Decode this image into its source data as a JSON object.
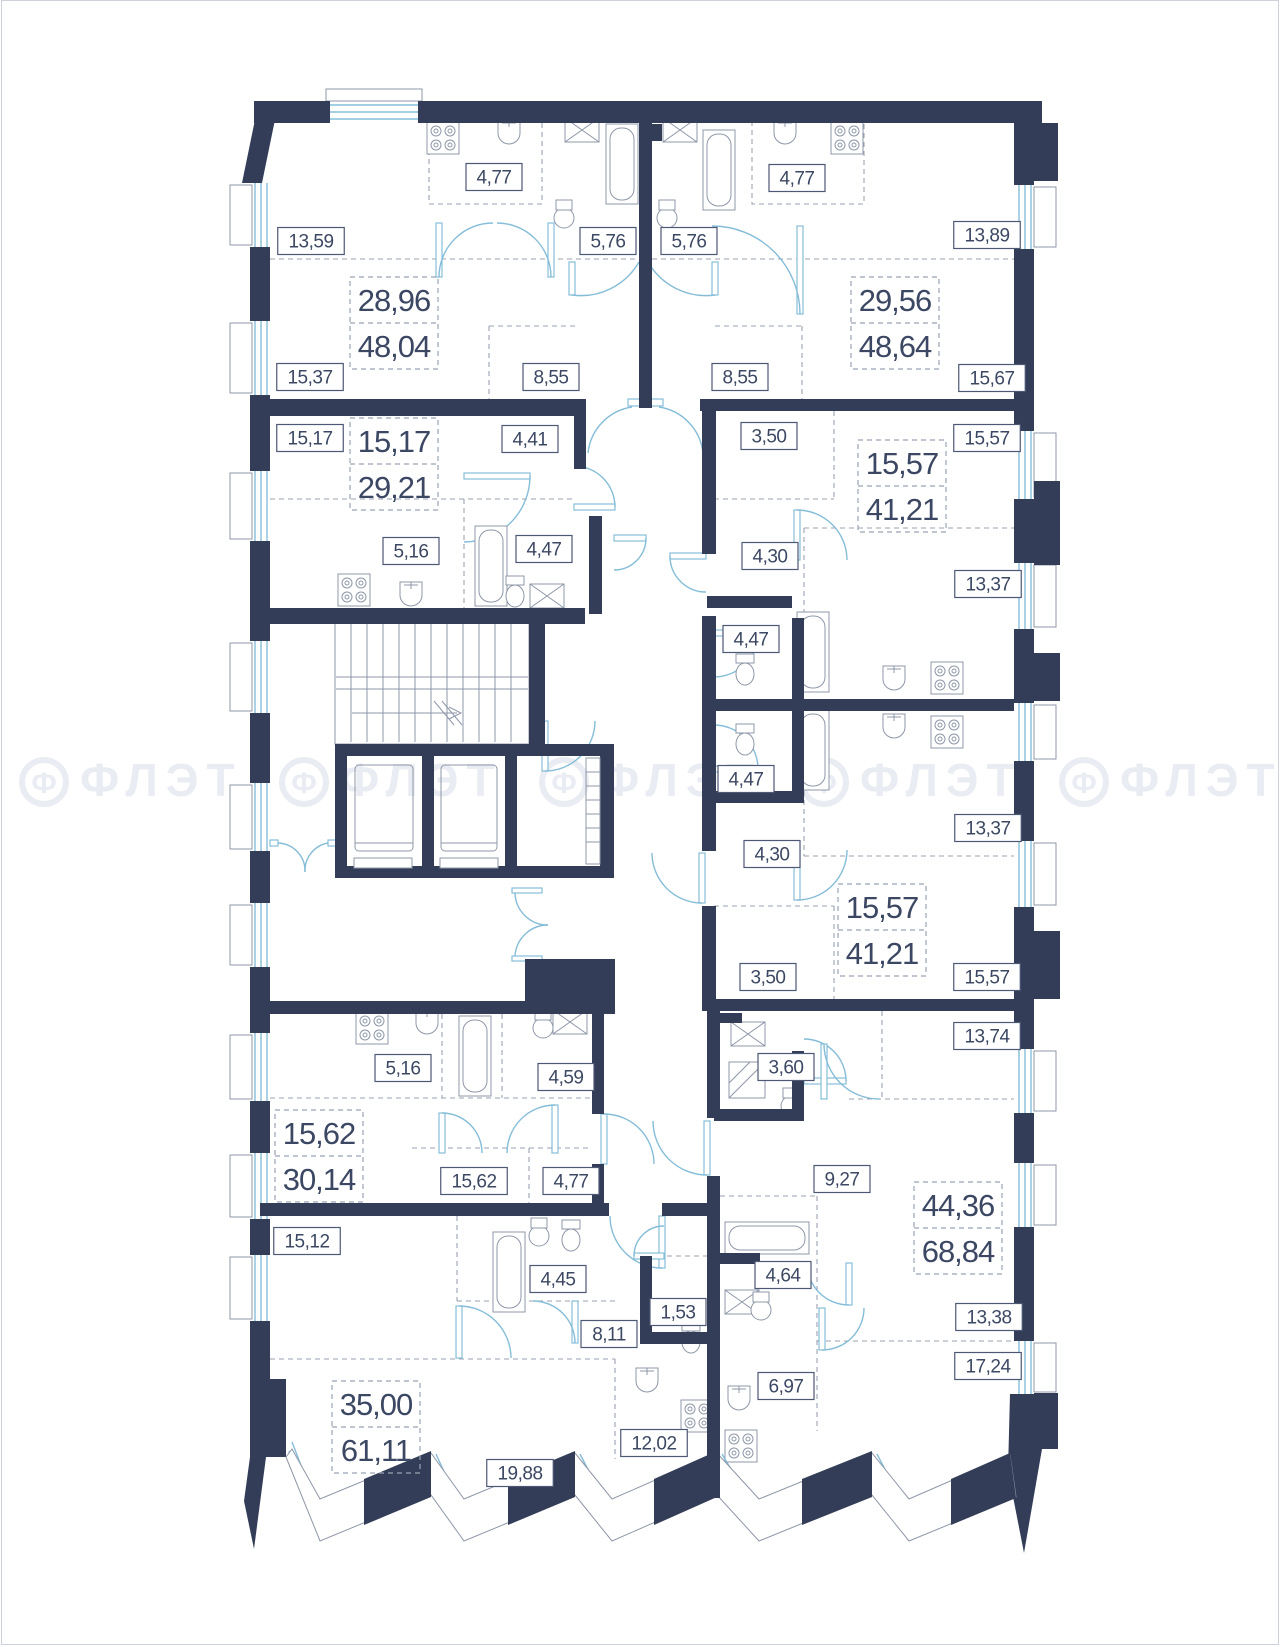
{
  "plan": {
    "colors": {
      "wall": "#333d57",
      "glazing": "#85bdd8",
      "label_text": "#3c4863",
      "dashed_zone": "#9aa3b3",
      "watermark": "#e9ecf2"
    },
    "watermark": {
      "logo_letter": "Ф",
      "text": "ФЛЭТ",
      "y": 795,
      "positions_x": [
        130,
        390,
        650,
        910,
        1170
      ]
    },
    "apartments": [
      {
        "living": "28,96",
        "total": "48,04",
        "cx": 392,
        "cy": 322
      },
      {
        "living": "29,56",
        "total": "48,64",
        "cx": 893,
        "cy": 322
      },
      {
        "living": "15,17",
        "total": "29,21",
        "cx": 392,
        "cy": 463
      },
      {
        "living": "15,57",
        "total": "41,21",
        "cx": 900,
        "cy": 485
      },
      {
        "living": "15,57",
        "total": "41,21",
        "cx": 880,
        "cy": 929
      },
      {
        "living": "15,62",
        "total": "30,14",
        "cx": 317,
        "cy": 1155
      },
      {
        "living": "44,36",
        "total": "68,84",
        "cx": 956,
        "cy": 1227
      },
      {
        "living": "35,00",
        "total": "61,11",
        "cx": 374,
        "cy": 1426
      }
    ],
    "room_labels": [
      {
        "text": "4,77",
        "cx": 492,
        "cy": 176
      },
      {
        "text": "13,59",
        "cx": 309,
        "cy": 240
      },
      {
        "text": "5,76",
        "cx": 606,
        "cy": 240
      },
      {
        "text": "15,37",
        "cx": 308,
        "cy": 376
      },
      {
        "text": "8,55",
        "cx": 549,
        "cy": 376
      },
      {
        "text": "4,77",
        "cx": 795,
        "cy": 177
      },
      {
        "text": "5,76",
        "cx": 687,
        "cy": 240
      },
      {
        "text": "13,89",
        "cx": 985,
        "cy": 234
      },
      {
        "text": "8,55",
        "cx": 738,
        "cy": 376
      },
      {
        "text": "15,67",
        "cx": 990,
        "cy": 377
      },
      {
        "text": "15,17",
        "cx": 308,
        "cy": 437
      },
      {
        "text": "4,41",
        "cx": 528,
        "cy": 438
      },
      {
        "text": "5,16",
        "cx": 409,
        "cy": 550
      },
      {
        "text": "4,47",
        "cx": 542,
        "cy": 548
      },
      {
        "text": "3,50",
        "cx": 767,
        "cy": 435
      },
      {
        "text": "15,57",
        "cx": 985,
        "cy": 437
      },
      {
        "text": "4,30",
        "cx": 768,
        "cy": 555
      },
      {
        "text": "13,37",
        "cx": 986,
        "cy": 583
      },
      {
        "text": "4,47",
        "cx": 749,
        "cy": 638
      },
      {
        "text": "4,47",
        "cx": 744,
        "cy": 778
      },
      {
        "text": "13,37",
        "cx": 986,
        "cy": 827
      },
      {
        "text": "4,30",
        "cx": 770,
        "cy": 853
      },
      {
        "text": "3,50",
        "cx": 766,
        "cy": 976
      },
      {
        "text": "15,57",
        "cx": 985,
        "cy": 976
      },
      {
        "text": "13,74",
        "cx": 985,
        "cy": 1035
      },
      {
        "text": "5,16",
        "cx": 401,
        "cy": 1067
      },
      {
        "text": "4,59",
        "cx": 564,
        "cy": 1076
      },
      {
        "text": "3,60",
        "cx": 784,
        "cy": 1066
      },
      {
        "text": "15,62",
        "cx": 472,
        "cy": 1180
      },
      {
        "text": "4,77",
        "cx": 569,
        "cy": 1180
      },
      {
        "text": "15,12",
        "cx": 305,
        "cy": 1240
      },
      {
        "text": "9,27",
        "cx": 840,
        "cy": 1178
      },
      {
        "text": "4,45",
        "cx": 556,
        "cy": 1278
      },
      {
        "text": "1,53",
        "cx": 676,
        "cy": 1311
      },
      {
        "text": "8,11",
        "cx": 607,
        "cy": 1333
      },
      {
        "text": "4,64",
        "cx": 781,
        "cy": 1274
      },
      {
        "text": "13,38",
        "cx": 987,
        "cy": 1316
      },
      {
        "text": "17,24",
        "cx": 986,
        "cy": 1365
      },
      {
        "text": "6,97",
        "cx": 784,
        "cy": 1385
      },
      {
        "text": "12,02",
        "cx": 652,
        "cy": 1442
      },
      {
        "text": "19,88",
        "cx": 518,
        "cy": 1472
      }
    ]
  }
}
